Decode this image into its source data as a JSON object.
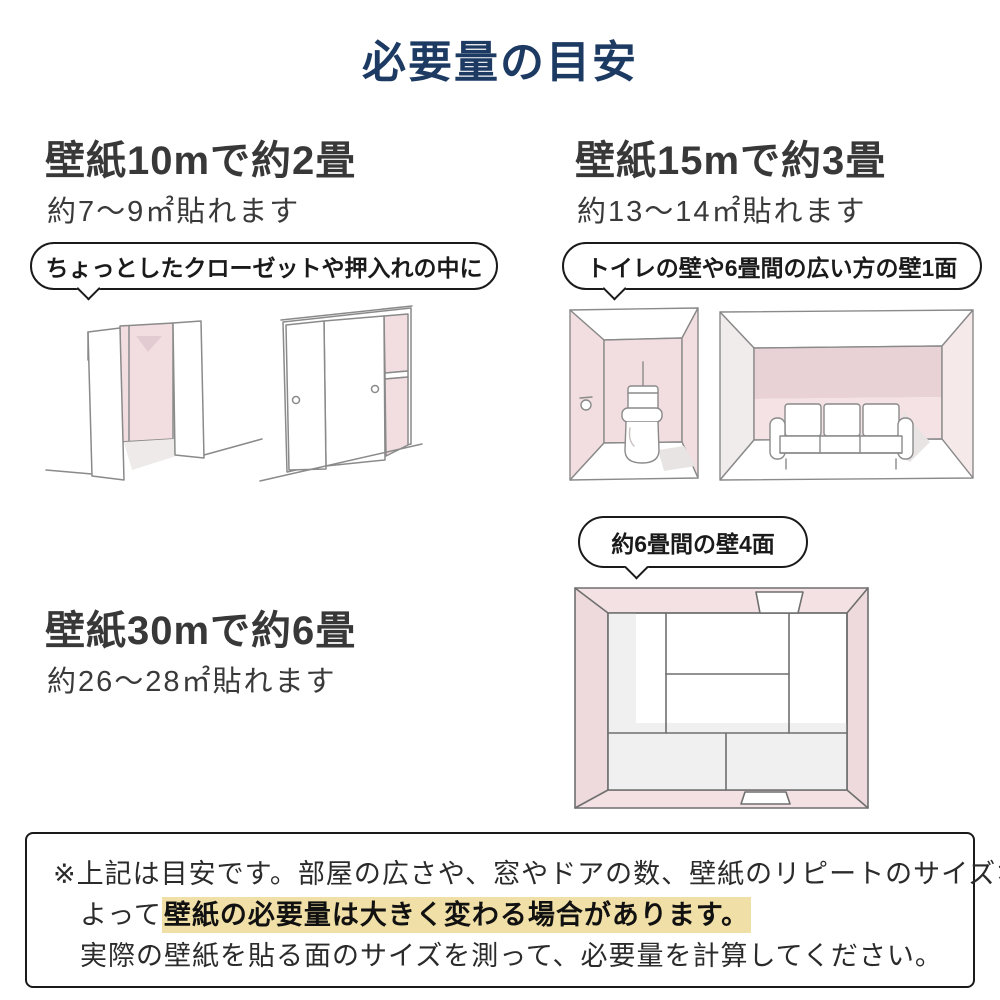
{
  "title": "必要量の目安",
  "sections": [
    {
      "heading": "壁紙10mで約2畳",
      "subtext": "約7〜9㎡貼れます",
      "bubble": "ちょっとしたクローゼットや押入れの中に"
    },
    {
      "heading": "壁紙15mで約3畳",
      "subtext": "約13〜14㎡貼れます",
      "bubble": "トイレの壁や6畳間の広い方の壁1面"
    },
    {
      "heading": "壁紙30mで約6畳",
      "subtext": "約26〜28㎡貼れます",
      "bubble": "約6畳間の壁4面"
    }
  ],
  "note": {
    "line1": "※上記は目安です。部屋の広さや、窓やドアの数、壁紙のリピートのサイズなどに",
    "line2_prefix": "よって",
    "line2_highlight": "壁紙の必要量は大きく変わる場合があります。",
    "line3": "実際の壁紙を貼る面のサイズを測って、必要量を計算してください。"
  },
  "colors": {
    "title_navy": "#1d3a63",
    "body_text": "#3a3a3a",
    "wall_pink": "#f2dee0",
    "wall_pink_dark": "#e8d2d6",
    "highlight_yellow": "#f0dfa6",
    "sketch_line": "#8a8a8a"
  },
  "illustrations": {
    "open_closet": "open-closet-sketch",
    "sliding_closet": "sliding-closet-sketch",
    "toilet_room": "toilet-room-sketch",
    "living_room": "living-room-sofa-sketch",
    "tatami_room": "tatami-room-top-view-sketch"
  }
}
